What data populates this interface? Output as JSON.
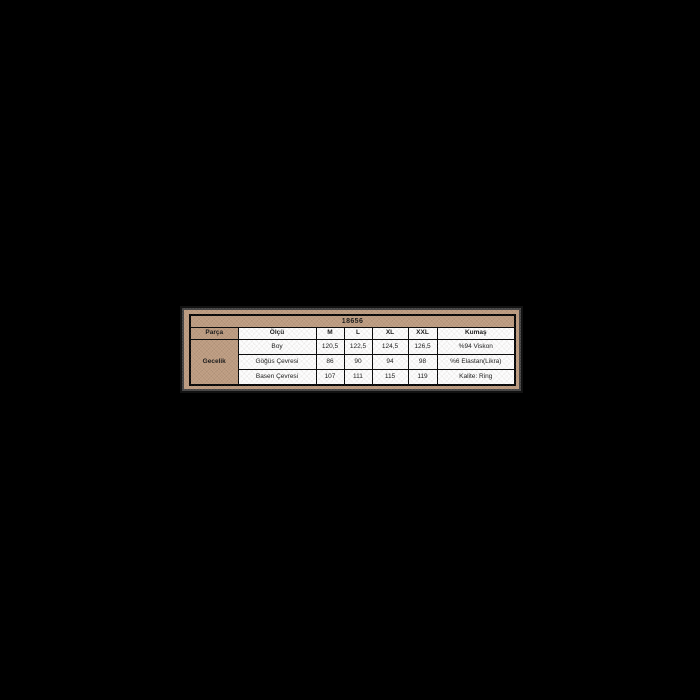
{
  "canvas": {
    "width": 700,
    "height": 700,
    "background": "#000000"
  },
  "panel": {
    "background": "#bc9a7e",
    "edge_speckle": "#969696",
    "table_background": "#fdfdfd",
    "border_color": "#000000",
    "text_color": "#121212"
  },
  "chart_data": {
    "type": "table",
    "title": "18656",
    "columns": [
      "Parça",
      "Ölçü",
      "M",
      "L",
      "XL",
      "XXL",
      "Kumaş"
    ],
    "row_group_label": "Gecelik",
    "rows": [
      [
        "Boy",
        "120,5",
        "122,5",
        "124,5",
        "126,5",
        "%94 Viskon"
      ],
      [
        "Göğüs Çevresi",
        "86",
        "90",
        "94",
        "98",
        "%6 Elastan(Likra)"
      ],
      [
        "Basen Çevresi",
        "107",
        "111",
        "115",
        "119",
        "Kalite: Ring"
      ]
    ]
  }
}
